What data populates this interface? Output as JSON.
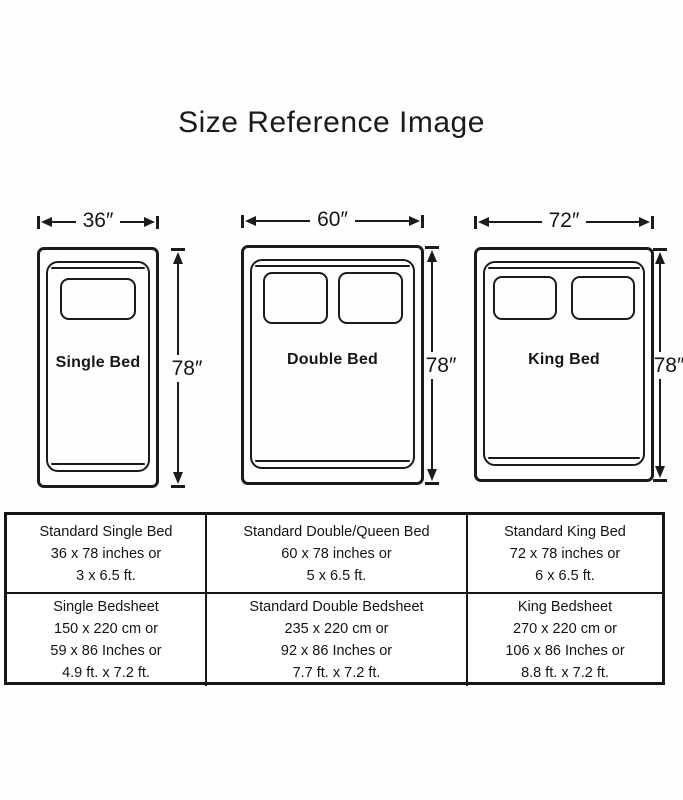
{
  "page": {
    "title": "Size Reference Image"
  },
  "colors": {
    "ink": "#1b1b1b",
    "background": "#ffffff"
  },
  "beds": [
    {
      "id": "single",
      "label": "Single Bed",
      "width_label": "36″",
      "height_label": "78″",
      "pillow_count": 1
    },
    {
      "id": "double",
      "label": "Double Bed",
      "width_label": "60″",
      "height_label": "78″",
      "pillow_count": 2
    },
    {
      "id": "king",
      "label": "King Bed",
      "width_label": "72″",
      "height_label": "78″",
      "pillow_count": 2
    }
  ],
  "table": {
    "rows": [
      {
        "cells": [
          {
            "lines": [
              "Standard Single Bed",
              "36 x 78 inches or",
              "3 x 6.5 ft."
            ]
          },
          {
            "lines": [
              "Standard Double/Queen Bed",
              "60 x 78 inches or",
              "5 x 6.5 ft."
            ]
          },
          {
            "lines": [
              "Standard King Bed",
              "72 x 78 inches or",
              "6 x 6.5 ft."
            ]
          }
        ]
      },
      {
        "cells": [
          {
            "lines": [
              "Single Bedsheet",
              "150 x 220 cm or",
              "59 x 86 Inches or",
              "4.9 ft. x 7.2 ft."
            ]
          },
          {
            "lines": [
              "Standard Double Bedsheet",
              "235 x 220 cm or",
              "92 x 86 Inches or",
              "7.7 ft. x 7.2 ft."
            ]
          },
          {
            "lines": [
              "King Bedsheet",
              "270 x 220 cm or",
              "106 x 86 Inches or",
              "8.8 ft. x 7.2 ft."
            ]
          }
        ]
      }
    ]
  }
}
